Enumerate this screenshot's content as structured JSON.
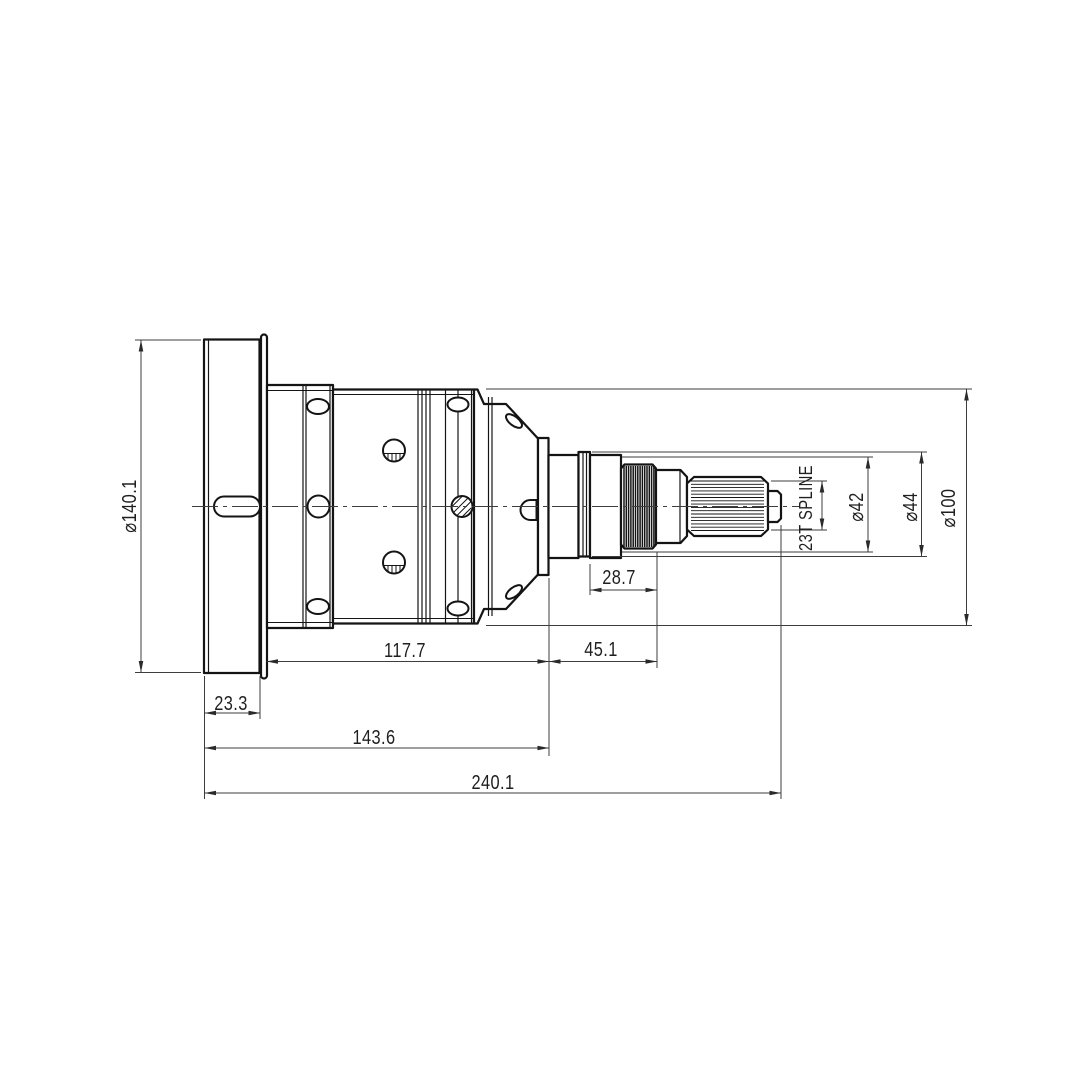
{
  "page": {
    "background": "#ffffff"
  },
  "drawing": {
    "type": "engineering-drawing",
    "view": "side-view",
    "part": "flanged axle shaft with splined end",
    "line_color": "#141414",
    "dim_color": "#3d3d3d",
    "dimensions": {
      "flange_diameter": "⌀140.1",
      "housing_diameter": "⌀100",
      "collar_diameter": "⌀44",
      "spline_diameter": "⌀42",
      "spline_callout": "23T SPLINE",
      "flange_thickness": "23.3",
      "housing_length": "117.7",
      "shaft_length": "45.1",
      "thread_length": "28.7",
      "flange_to_housing_face": "143.6",
      "overall_length": "240.1"
    }
  }
}
